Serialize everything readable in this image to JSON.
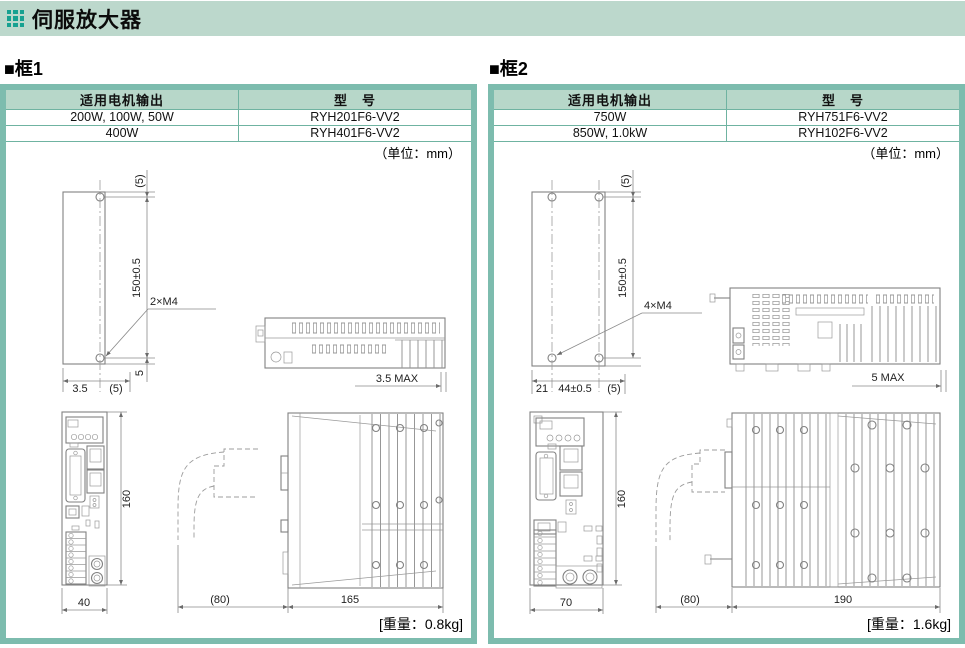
{
  "page": {
    "title": "伺服放大器"
  },
  "colors": {
    "titlebar_bg": "#bcd8cc",
    "icon_teal": "#17a191",
    "frame_border": "#7dbcae",
    "table_header_bg": "#b7d7c9",
    "table_grid": "#6fb3a1"
  },
  "frames": [
    {
      "heading": "■框1",
      "table": {
        "headers": [
          "适用电机输出",
          "型　号"
        ],
        "rows": [
          [
            "200W, 100W, 50W",
            "RYH201F6-VV2"
          ],
          [
            "400W",
            "RYH401F6-VV2"
          ]
        ]
      },
      "unit_note": "（单位：mm）",
      "weight_note": "[重量：0.8kg]",
      "dims": {
        "top_offset": "(5)",
        "mount_pitch": "150±0.5",
        "bottom_offset": "5",
        "screw_label": "2×M4",
        "base_a": "3.5",
        "base_b": "(5)",
        "din_clearance": "3.5 MAX",
        "front_height": "160",
        "front_width": "40",
        "cable_clearance": "(80)",
        "body_depth": "165"
      }
    },
    {
      "heading": "■框2",
      "table": {
        "headers": [
          "适用电机输出",
          "型　号"
        ],
        "rows": [
          [
            "750W",
            "RYH751F6-VV2"
          ],
          [
            "850W, 1.0kW",
            "RYH102F6-VV2"
          ]
        ]
      },
      "unit_note": "（单位：mm）",
      "weight_note": "[重量：1.6kg]",
      "dims": {
        "top_offset": "(5)",
        "mount_pitch": "150±0.5",
        "screw_label": "4×M4",
        "base_a": "21",
        "base_b": "44±0.5",
        "base_c": "(5)",
        "din_clearance": "5 MAX",
        "front_height": "160",
        "front_width": "70",
        "cable_clearance": "(80)",
        "body_depth": "190"
      }
    }
  ]
}
